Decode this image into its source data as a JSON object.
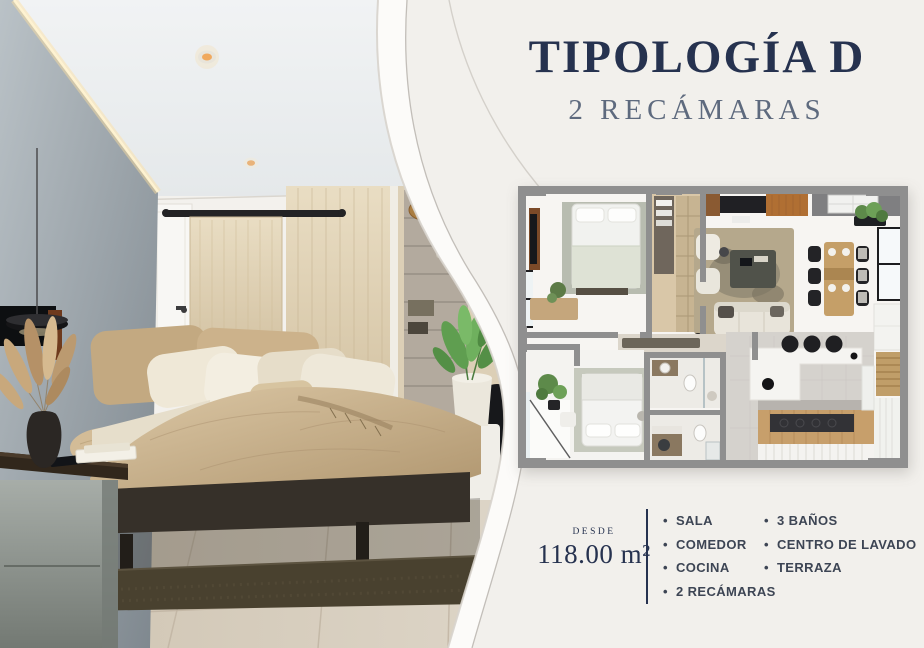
{
  "header": {
    "title": "TIPOLOGÍA D",
    "subtitle": "2 RECÁMARAS"
  },
  "details": {
    "desde_label": "DESDE",
    "area_value": "118.00 m²",
    "features_left": [
      "SALA",
      "COMEDOR",
      "COCINA",
      "2 RECÁMARAS"
    ],
    "features_right": [
      "3 BAÑOS",
      "CENTRO DE LAVADO",
      "TERRAZA"
    ]
  },
  "media": {
    "photo_label": "bedroom-interior-photo",
    "floorplan_label": "apartment-floorplan-top-view"
  },
  "colors": {
    "navy": "#26324f",
    "subtitle": "#5e6a7e",
    "text": "#3d4554",
    "divider": "#26324f",
    "panel_bg": "#f2f0ec",
    "curve_line": "#bcb8b2",
    "wood": "#d8c7a6",
    "wall_gray": "#8f8f8f"
  }
}
